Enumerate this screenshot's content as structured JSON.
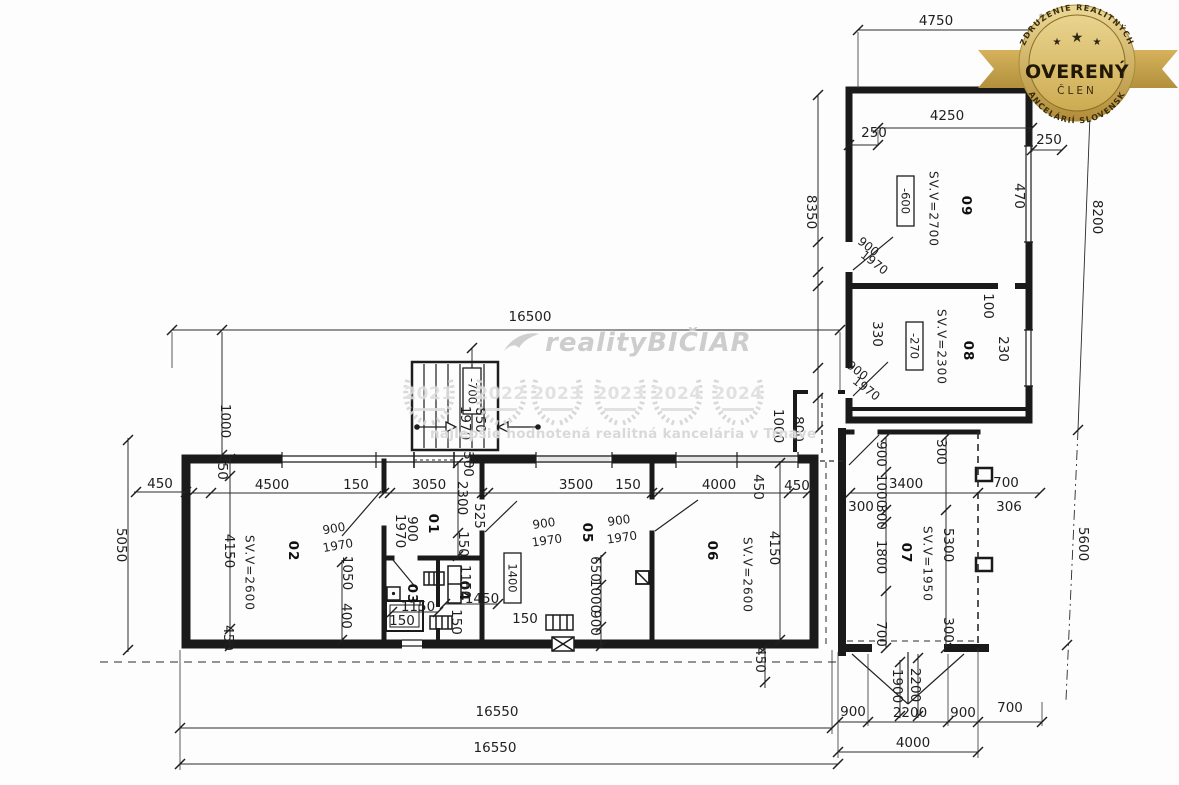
{
  "badge": {
    "arc_top": "ZDRUŽENIE REALITNÝCH",
    "arc_bottom": "KANCELÁRIÍ SLOVENSKA",
    "title": "OVERENÝ",
    "subtitle": "ČLEN",
    "stars": [
      "★",
      "★",
      "★"
    ],
    "gold": "#c9a84c"
  },
  "watermark": {
    "brand": "realityBIČIAR",
    "tagline": "najlepšie hodnotená realitná kancelária v Trnave",
    "years": [
      "2021",
      "2022",
      "2023",
      "2023",
      "2024",
      "2024"
    ]
  },
  "plan": {
    "labels": [
      {
        "t": "01",
        "x": 433,
        "y": 524,
        "r": 90,
        "s": 26,
        "k": "room"
      },
      {
        "t": "02",
        "x": 293,
        "y": 551,
        "r": 90,
        "s": 30,
        "k": "room"
      },
      {
        "t": "03",
        "x": 412,
        "y": 594,
        "r": 90,
        "s": 23,
        "k": "room"
      },
      {
        "t": "04",
        "x": 464,
        "y": 591,
        "r": 90,
        "s": 23,
        "k": "room"
      },
      {
        "t": "05",
        "x": 587,
        "y": 533,
        "r": 90,
        "s": 30,
        "k": "room"
      },
      {
        "t": "06",
        "x": 712,
        "y": 551,
        "r": 90,
        "s": 30,
        "k": "room"
      },
      {
        "t": "07",
        "x": 906,
        "y": 553,
        "r": 90,
        "s": 30,
        "k": "room"
      },
      {
        "t": "08",
        "x": 968,
        "y": 351,
        "r": 90,
        "s": 30,
        "k": "room"
      },
      {
        "t": "09",
        "x": 966,
        "y": 206,
        "r": 90,
        "s": 30,
        "k": "room"
      },
      {
        "t": "SV.V=2700",
        "x": 933,
        "y": 209,
        "r": 90,
        "k": "height"
      },
      {
        "t": "SV.V=2300",
        "x": 941,
        "y": 347,
        "r": 90,
        "k": "height"
      },
      {
        "t": "SV.V=2600",
        "x": 249,
        "y": 573,
        "r": 90,
        "k": "height"
      },
      {
        "t": "SV.V=2600",
        "x": 747,
        "y": 575,
        "r": 90,
        "k": "height"
      },
      {
        "t": "SV.V=1950",
        "x": 927,
        "y": 564,
        "r": 90,
        "k": "height"
      },
      {
        "t": "-600",
        "x": 905,
        "y": 201,
        "r": 90,
        "k": "level"
      },
      {
        "t": "-270",
        "x": 914,
        "y": 346,
        "r": 90,
        "k": "level"
      },
      {
        "t": "-700",
        "x": 472,
        "y": 391,
        "r": 90,
        "k": "level"
      },
      {
        "t": "1400",
        "x": 512,
        "y": 578,
        "r": 90,
        "k": "level"
      },
      {
        "t": "4750",
        "x": 936,
        "y": 21
      },
      {
        "t": "4250",
        "x": 947,
        "y": 116
      },
      {
        "t": "250",
        "x": 874,
        "y": 133
      },
      {
        "t": "250",
        "x": 1049,
        "y": 140
      },
      {
        "t": "16500",
        "x": 530,
        "y": 317
      },
      {
        "t": "450",
        "x": 160,
        "y": 484
      },
      {
        "t": "4500",
        "x": 272,
        "y": 485
      },
      {
        "t": "150",
        "x": 356,
        "y": 485
      },
      {
        "t": "3050",
        "x": 429,
        "y": 485
      },
      {
        "t": "3500",
        "x": 576,
        "y": 485
      },
      {
        "t": "150",
        "x": 628,
        "y": 485
      },
      {
        "t": "4000",
        "x": 719,
        "y": 485
      },
      {
        "t": "450",
        "x": 797,
        "y": 486
      },
      {
        "t": "3400",
        "x": 906,
        "y": 484
      },
      {
        "t": "700",
        "x": 1006,
        "y": 483
      },
      {
        "t": "300",
        "x": 861,
        "y": 507,
        "s": 11.5
      },
      {
        "t": "306",
        "x": 1009,
        "y": 507,
        "s": 11.5
      },
      {
        "t": "1150",
        "x": 418,
        "y": 607,
        "s": 12
      },
      {
        "t": "150",
        "x": 402,
        "y": 621,
        "s": 12
      },
      {
        "t": "1450",
        "x": 482,
        "y": 599,
        "s": 12
      },
      {
        "t": "150",
        "x": 525,
        "y": 619,
        "s": 12
      },
      {
        "t": "16550",
        "x": 497,
        "y": 712
      },
      {
        "t": "16550",
        "x": 495,
        "y": 748
      },
      {
        "t": "900",
        "x": 853,
        "y": 712,
        "s": 12.5
      },
      {
        "t": "2200",
        "x": 910,
        "y": 713,
        "s": 12.5
      },
      {
        "t": "900",
        "x": 963,
        "y": 713,
        "s": 12.5
      },
      {
        "t": "700",
        "x": 1010,
        "y": 708,
        "s": 12.5
      },
      {
        "t": "4000",
        "x": 913,
        "y": 743
      },
      {
        "t": "900",
        "x": 334,
        "y": 529,
        "r": -10,
        "k": "door"
      },
      {
        "t": "1970",
        "x": 338,
        "y": 546,
        "r": -10,
        "k": "door"
      },
      {
        "t": "900",
        "x": 544,
        "y": 524,
        "r": -8,
        "k": "door"
      },
      {
        "t": "1970",
        "x": 547,
        "y": 541,
        "r": -8,
        "k": "door"
      },
      {
        "t": "900",
        "x": 619,
        "y": 521,
        "r": -8,
        "k": "door"
      },
      {
        "t": "1970",
        "x": 622,
        "y": 538,
        "r": -8,
        "k": "door"
      },
      {
        "t": "900",
        "x": 868,
        "y": 247,
        "r": 38,
        "k": "door"
      },
      {
        "t": "1970",
        "x": 874,
        "y": 263,
        "r": 38,
        "k": "door"
      },
      {
        "t": "900",
        "x": 857,
        "y": 371,
        "r": 38,
        "k": "door"
      },
      {
        "t": "1970",
        "x": 866,
        "y": 389,
        "r": 38,
        "k": "door"
      },
      {
        "t": "8350",
        "x": 811,
        "y": 212,
        "r": 90,
        "s": 12.5
      },
      {
        "t": "8200",
        "x": 1097,
        "y": 217,
        "r": 90,
        "s": 12.5
      },
      {
        "t": "5050",
        "x": 121,
        "y": 545,
        "r": 90,
        "s": 12.5
      },
      {
        "t": "1000",
        "x": 225,
        "y": 421,
        "r": 90,
        "s": 12
      },
      {
        "t": "450",
        "x": 222,
        "y": 467,
        "r": 90,
        "s": 11.5
      },
      {
        "t": "4150",
        "x": 229,
        "y": 551,
        "r": 90,
        "s": 12.5
      },
      {
        "t": "450",
        "x": 228,
        "y": 638,
        "r": 90,
        "s": 11.5
      },
      {
        "t": "470",
        "x": 1019,
        "y": 196,
        "r": 90,
        "s": 12
      },
      {
        "t": "230",
        "x": 1003,
        "y": 349,
        "r": 90,
        "s": 12
      },
      {
        "t": "100",
        "x": 988,
        "y": 306,
        "r": 90,
        "s": 11
      },
      {
        "t": "330",
        "x": 877,
        "y": 334,
        "r": 90,
        "s": 12
      },
      {
        "t": "450",
        "x": 758,
        "y": 487,
        "r": 90,
        "s": 11.5
      },
      {
        "t": "2300",
        "x": 462,
        "y": 498,
        "r": 90,
        "s": 12
      },
      {
        "t": "150",
        "x": 463,
        "y": 544,
        "r": 90,
        "s": 11
      },
      {
        "t": "300",
        "x": 468,
        "y": 464,
        "r": 90,
        "s": 11
      },
      {
        "t": "525",
        "x": 479,
        "y": 516,
        "r": 90,
        "s": 11
      },
      {
        "t": "1970",
        "x": 400,
        "y": 531,
        "r": 90,
        "s": 11.5
      },
      {
        "t": "900",
        "x": 412,
        "y": 529,
        "r": 90,
        "s": 11.5
      },
      {
        "t": "1150",
        "x": 465,
        "y": 582,
        "r": 90,
        "s": 11
      },
      {
        "t": "150",
        "x": 456,
        "y": 622,
        "r": 90,
        "s": 11
      },
      {
        "t": "1050",
        "x": 347,
        "y": 573,
        "r": 90,
        "s": 11.5
      },
      {
        "t": "400",
        "x": 346,
        "y": 616,
        "r": 90,
        "s": 11.5
      },
      {
        "t": "650",
        "x": 595,
        "y": 569,
        "r": 90,
        "s": 11.5
      },
      {
        "t": "1000",
        "x": 595,
        "y": 596,
        "r": 90,
        "s": 11.5
      },
      {
        "t": "900",
        "x": 595,
        "y": 623,
        "r": 90,
        "s": 11.5
      },
      {
        "t": "4150",
        "x": 774,
        "y": 548,
        "r": 90,
        "s": 12.5
      },
      {
        "t": "1000",
        "x": 778,
        "y": 426,
        "r": 90,
        "s": 11.5
      },
      {
        "t": "800",
        "x": 798,
        "y": 429,
        "r": 90,
        "s": 11.5
      },
      {
        "t": "900",
        "x": 881,
        "y": 454,
        "r": 90,
        "s": 11.5
      },
      {
        "t": "1000",
        "x": 881,
        "y": 491,
        "r": 90,
        "s": 11.5
      },
      {
        "t": "300",
        "x": 881,
        "y": 517,
        "r": 90,
        "s": 11
      },
      {
        "t": "1800",
        "x": 881,
        "y": 557,
        "r": 90,
        "s": 11.5
      },
      {
        "t": "700",
        "x": 881,
        "y": 634,
        "r": 90,
        "s": 11.5
      },
      {
        "t": "300",
        "x": 941,
        "y": 452,
        "r": 90,
        "s": 11
      },
      {
        "t": "5300",
        "x": 948,
        "y": 545,
        "r": 90,
        "s": 12.5
      },
      {
        "t": "300",
        "x": 948,
        "y": 630,
        "r": 90,
        "s": 11
      },
      {
        "t": "5600",
        "x": 1083,
        "y": 544,
        "r": 90,
        "s": 12.5
      },
      {
        "t": "1900",
        "x": 897,
        "y": 686,
        "r": 90,
        "s": 11.5
      },
      {
        "t": "2200",
        "x": 915,
        "y": 685,
        "r": 90,
        "s": 11.5
      },
      {
        "t": "450",
        "x": 760,
        "y": 660,
        "r": 90,
        "s": 11.5
      },
      {
        "t": "1970",
        "x": 465,
        "y": 423,
        "r": 90,
        "s": 11.5
      },
      {
        "t": "850",
        "x": 480,
        "y": 420,
        "r": 90,
        "s": 11.5
      }
    ]
  }
}
